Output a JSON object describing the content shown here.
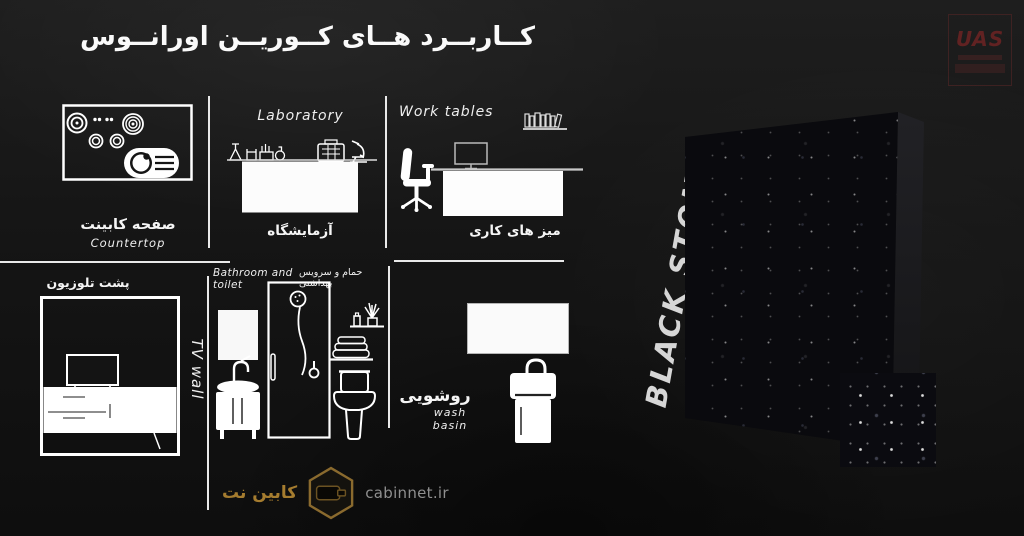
{
  "title": "کــاربــرد هــای کــوریــن اورانــوس",
  "watermark": {
    "text": "UAS"
  },
  "sections": {
    "countertop": {
      "label_fa": "صفحه کابینت",
      "label_en": "Countertop"
    },
    "laboratory": {
      "heading_en": "Laboratory",
      "label_fa": "آزمایشگاه"
    },
    "work_tables": {
      "heading_en": "Work tables",
      "label_fa": "میز های کاری"
    },
    "tv_wall": {
      "label_fa": "پشت تلوزیون",
      "rotated_label_en": "TV wall"
    },
    "bathroom": {
      "heading_en": "Bathroom and toilet",
      "heading_fa": "حمام و سرویس بهداشتی"
    },
    "wash_basin": {
      "label_fa": "روشویی",
      "label_en": "wash basin"
    }
  },
  "stone": {
    "label": "BLACK STONE"
  },
  "footer": {
    "brand_fa": "کابین نت",
    "website": "cabinnet.ir"
  },
  "colors": {
    "background": "#151515",
    "line_white": "#e9e9e9",
    "stone_black": "#0a0a0e",
    "gold_accent": "#a57c2f",
    "watermark_red": "#7a2424",
    "url_gray": "#8f8f8f"
  }
}
